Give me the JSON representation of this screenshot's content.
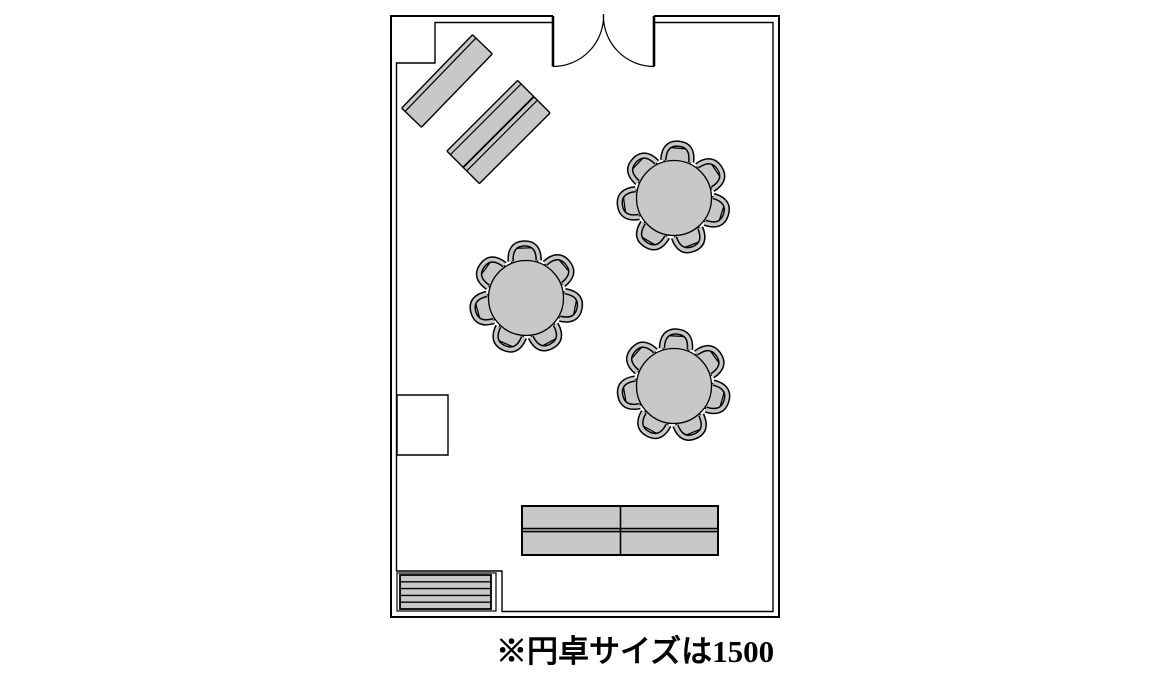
{
  "caption": {
    "text": "※円卓サイズは1500"
  },
  "colors": {
    "background": "#ffffff",
    "line": "#000000",
    "furniture_fill": "#c8c8c8",
    "wall_fill": "#ffffff"
  },
  "round_table_note": {
    "size_value": "1500"
  },
  "furniture": {
    "diagonal_tables": [
      {
        "cx": 447,
        "cy": 81,
        "length": 102,
        "width": 27.5,
        "rotation": -46,
        "edge_lines": [
          {
            "y": -9,
            "w": 1.2
          }
        ]
      },
      {
        "cx": 498.5,
        "cy": 132,
        "length": 100,
        "width": 46,
        "rotation": -45,
        "edge_lines": [
          {
            "y": -18,
            "w": 1.2
          },
          {
            "y": 0,
            "w": 1.8
          },
          {
            "y": 5,
            "w": 1.2
          }
        ]
      }
    ],
    "round_tables": {
      "table_radius": 37.5,
      "chair_radius": 46,
      "chairs_per_table": 7,
      "tables": [
        {
          "cx": 674,
          "cy": 198,
          "chair_start_angle": 5
        },
        {
          "cx": 526,
          "cy": 298,
          "chair_start_angle": -2
        },
        {
          "cx": 674,
          "cy": 386,
          "chair_start_angle": 3
        }
      ]
    },
    "bottom_tables": {
      "x": 522,
      "y": 506,
      "width": 196,
      "height": 49,
      "vline_x": 620.5,
      "hlines": [
        528.6,
        531.6
      ]
    },
    "stripe_panel": {
      "container": {
        "x": 397,
        "y": 573,
        "width": 99,
        "height": 38
      },
      "panel": {
        "x": 400,
        "y": 575,
        "width": 91,
        "height": 34
      },
      "internal_lines": 4
    }
  }
}
